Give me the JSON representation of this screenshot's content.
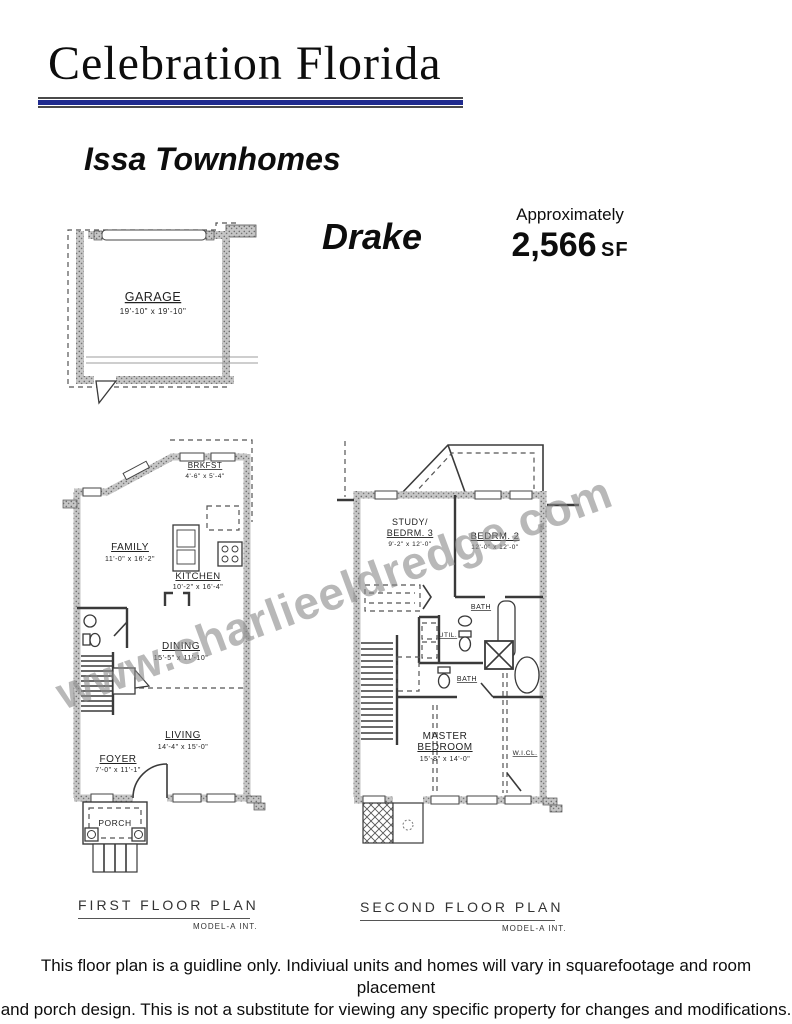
{
  "header": {
    "brand": "Celebration Florida",
    "community": "Issa Townhomes"
  },
  "model": {
    "name": "Drake",
    "approx_label": "Approximately",
    "sf_value": "2,566",
    "sf_unit": "SF"
  },
  "watermark": "www.charlieeldredge.com",
  "garage": {
    "name": "GARAGE",
    "dims": "19'-10\" x 19'-10\""
  },
  "first_floor": {
    "caption": "FIRST FLOOR PLAN",
    "model_note": "MODEL-A INT.",
    "rooms": {
      "brkfst": {
        "name": "BRKFST",
        "dims": "4'-6\" x 5'-4\""
      },
      "family": {
        "name": "FAMILY",
        "dims": "11'-0\" x 16'-2\""
      },
      "kitchen": {
        "name": "KITCHEN",
        "dims": "10'-2\" x 16'-4\""
      },
      "dining": {
        "name": "DINING",
        "dims": "15'-5\" x 11'-10\""
      },
      "living": {
        "name": "LIVING",
        "dims": "14'-4\" x 15'-0\""
      },
      "foyer": {
        "name": "FOYER",
        "dims": "7'-0\" x 11'-1\""
      },
      "porch": {
        "name": "PORCH"
      }
    }
  },
  "second_floor": {
    "caption": "SECOND FLOOR PLAN",
    "model_note": "MODEL-A INT.",
    "rooms": {
      "study": {
        "line1": "STUDY/",
        "line2": "BEDRM. 3",
        "dims": "9'-2\" x 12'-0\""
      },
      "bedrm2": {
        "name": "BEDRM. 2",
        "dims": "12'-0\" x 12'-0\""
      },
      "bath_upper": {
        "name": "BATH"
      },
      "util": {
        "name": "UTIL."
      },
      "bath_lower": {
        "name": "BATH"
      },
      "master": {
        "line1": "MASTER",
        "line2": "BEDROOM",
        "dims": "15'-8\" x 14'-0\""
      },
      "wicl": {
        "name": "W.I.CL."
      }
    }
  },
  "colors": {
    "accent_navy": "#1f2a8e",
    "line_dark": "#3a3a3a",
    "wall_gray": "#9a9a9a",
    "watermark_gray": "#8a8a8a"
  },
  "disclaimer": {
    "line1": "This floor plan is a guidline only.  Indiviual units and homes will vary in squarefootage and room placement",
    "line2": "and porch design. This is not a substitute for viewing any specific property for changes and modifications."
  }
}
